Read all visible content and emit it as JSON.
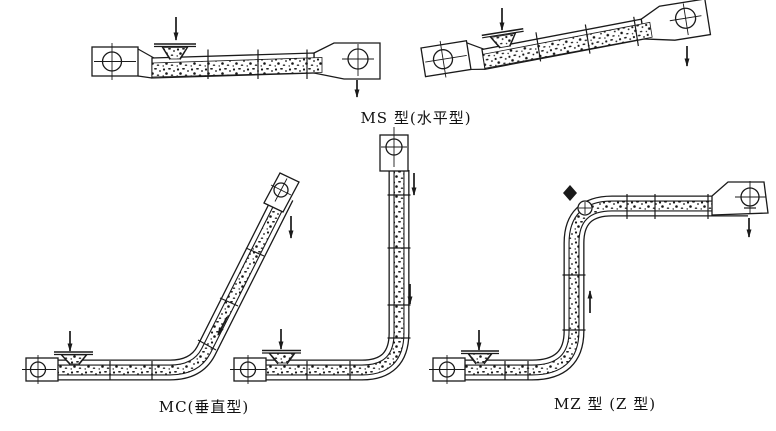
{
  "labels": {
    "ms": "MS 型(水平型)",
    "mc": "MC(垂直型)",
    "mz": "MZ 型 (Z 型)"
  },
  "colors": {
    "ink": "#1a1a1a",
    "background": "#ffffff"
  },
  "icons": {
    "feed_arrow": "down-arrow",
    "discharge_arrow": "down-arrow",
    "return_flow_arrow": "down-arrow",
    "lift_flow_arrow": "up-arrow"
  },
  "figure": {
    "variants": [
      {
        "code": "MS",
        "layout": "horizontal"
      },
      {
        "code": "MC",
        "layout": "vertical / inclined L"
      },
      {
        "code": "MZ",
        "layout": "Z-shaped"
      }
    ]
  }
}
